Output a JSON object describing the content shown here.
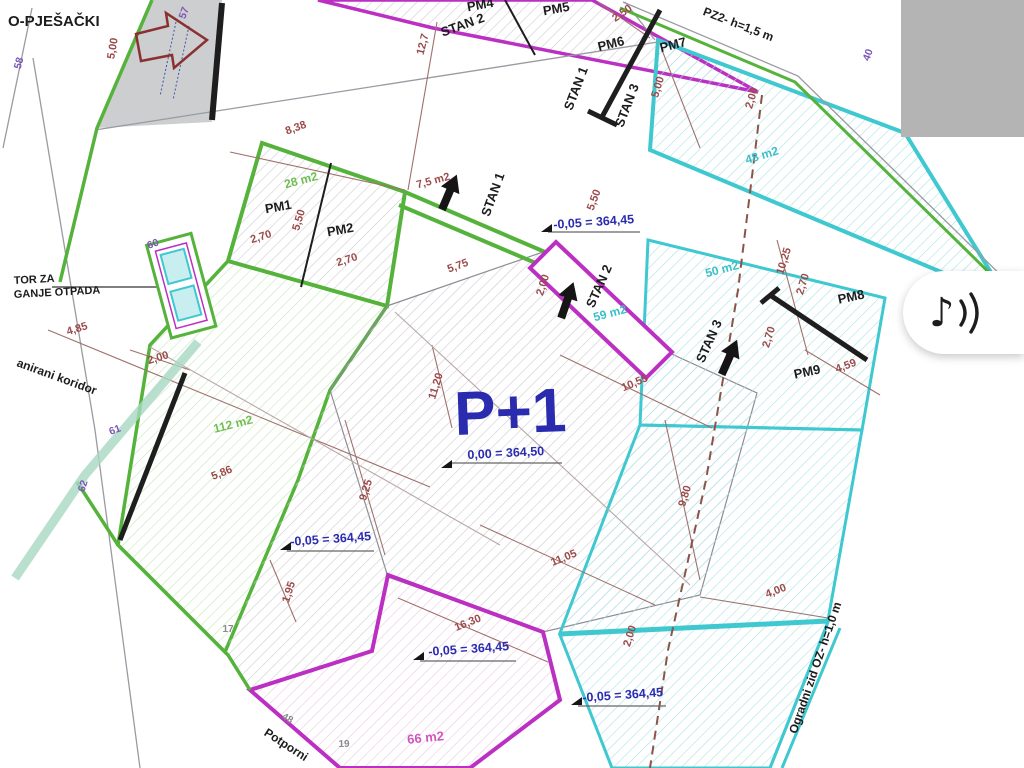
{
  "plan": {
    "labels": {
      "street": "O-PJEŠAČKI",
      "n57": "57",
      "n58": "58",
      "n60": "60",
      "n61": "61",
      "n62": "62",
      "n40": "40",
      "n17": "17",
      "n19": "19",
      "n48": "48",
      "pm1": "PM1",
      "pm2": "PM2",
      "pm4": "PM4",
      "pm5": "PM5",
      "pm6": "PM6",
      "pm7": "PM7",
      "pm8": "PM8",
      "pm9": "PM9",
      "stan1_top": "STAN 1",
      "stan2_top": "STAN 2",
      "stan3_top": "STAN 3",
      "stan1": "STAN 1",
      "stan2": "STAN 2",
      "stan3": "STAN 3",
      "pz2": "PZ2- h=1,5 m",
      "ogradni": "Ogradni zid OZ- h=1,0 m",
      "tor1": "TOR ZA",
      "tor2": "GANJE OTPADA",
      "koridor": "anirani koridor",
      "potporni": "Potporni",
      "p1": "P+1",
      "elev_00": "0,00 = 364,50",
      "elev_05a": "-0,05 = 364,45",
      "elev_05b": "-0,05 = 364,45",
      "elev_05c": "-0,05 = 364,45",
      "elev_05d": "-0,05 = 364,45",
      "area28": "28 m2",
      "area75": "7,5 m2",
      "area48": "48 m2",
      "area50": "50 m2",
      "area59": "59 m2",
      "area112": "112 m2",
      "area66": "66 m2",
      "d500a": "5,00",
      "d500b": "5,00",
      "d838": "8,38",
      "d127": "12,7",
      "d250": "2,50",
      "d270a": "2,70",
      "d270b": "2,70",
      "d270c": "2,70",
      "d270d": "2,70",
      "d550a": "5,50",
      "d550b": "5,50",
      "d575": "5,75",
      "d200a": "2,00",
      "d200b": "2,00",
      "d200c": "2,00",
      "d200d": "2,00",
      "d1025": "10,25",
      "d459": "4,59",
      "d1055": "10,55",
      "d1120": "11,20",
      "d980": "9,80",
      "d485": "4,85",
      "d586": "5,86",
      "d925": "9,25",
      "d1105": "11,05",
      "d1630": "16,30",
      "d195": "1,95",
      "d400": "4,00"
    }
  },
  "floating_button": {
    "name": "audio",
    "icon": "music-note-icon",
    "char": "♪"
  },
  "colors": {
    "green": "#55b33b",
    "magenta": "#bb2fc2",
    "cyan": "#3fc8cf",
    "dim_red": "#9c4b4b",
    "blue": "#2b2bb0",
    "purple": "#7d55b8",
    "gray_block": "#b4b4b4"
  }
}
